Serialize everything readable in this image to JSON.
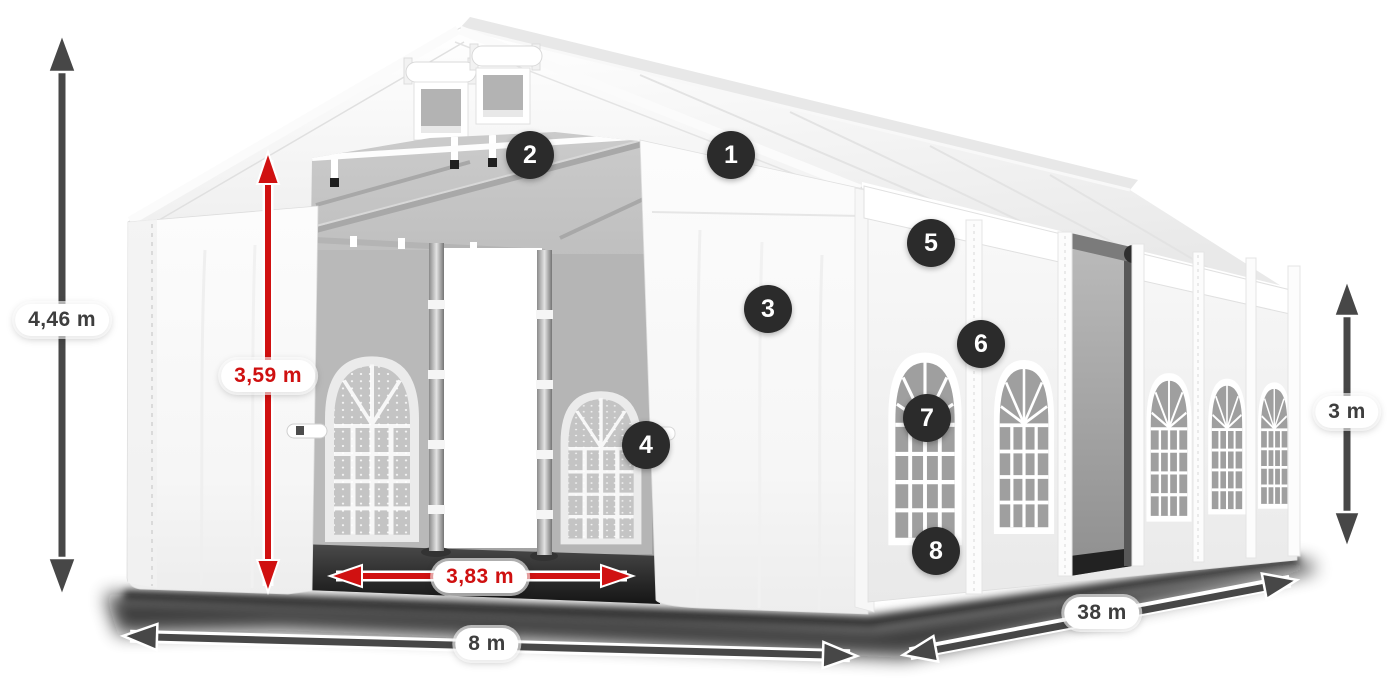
{
  "diagram": {
    "title": "Marquee tent dimension diagram",
    "dimensions": {
      "total_height": "4,46 m",
      "entrance_height": "3,59 m",
      "entrance_width": "3,83 m",
      "front_width": "8 m",
      "length": "38 m",
      "side_wall_height": "3 m"
    },
    "callouts": [
      "1",
      "2",
      "3",
      "4",
      "5",
      "6",
      "7",
      "8"
    ],
    "colors": {
      "dimension_primary": "#474747",
      "dimension_accent_red": "#d01111",
      "callout_badge_background": "#2b2b2b",
      "callout_badge_text": "#ffffff",
      "label_pill_background": "#ffffff",
      "label_text": "#3e3e3e"
    }
  }
}
